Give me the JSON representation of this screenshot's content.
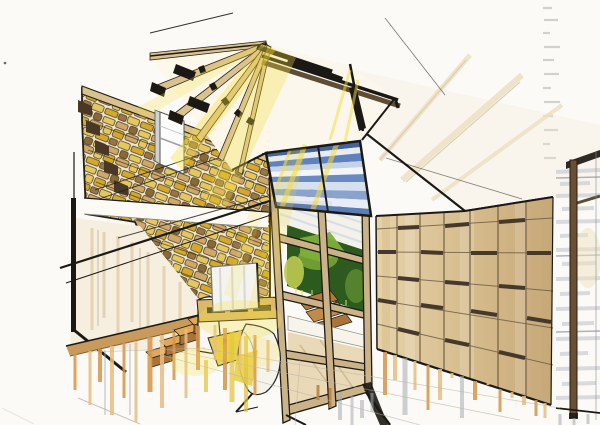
{
  "image": {
    "type": "architectural-marker-sketch",
    "description": "Hand-drawn marker and ink interior perspective: stone feature wall with staircase, exposed timber roof rafters with yellow sunlight rays, blue-striped clerestory glazing, timber glazed partition with green plant wall behind, wood panelled wall, media screen, chaise with drapery, floor dissolving into marker drips"
  },
  "scene": {
    "elements": [
      "stone-wall",
      "staircase",
      "roof-rafters",
      "ridge-beam",
      "clerestory-window",
      "sunlight-rays",
      "glass-partition",
      "plant-wall",
      "bench",
      "media-screen",
      "media-console",
      "chaise-longue",
      "wood-panel-wall",
      "glazed-door",
      "ceiling-plane",
      "marker-drips",
      "watermark"
    ]
  },
  "palette": {
    "paper": "#fbfaf6",
    "ink": "#1c1914",
    "stone_mortar": "#f0e6cc",
    "stone_ochre": "#d2a92a",
    "stone_gold": "#e4c75e",
    "stone_tan": "#cfa768",
    "stone_brown": "#9a7442",
    "stone_dark": "#8a6a34",
    "wood_beam": "#d9c190",
    "wood_line": "#5d4c36",
    "wood_floor": "#c89a5c",
    "step_tread": "#e2a858",
    "step_riser": "#a8743a",
    "sunlight": "#f6dd3e",
    "sky_dark": "#44639e",
    "sky_blue": "#5f82bd",
    "sky_light": "#aebfdd",
    "glass_gray": "#b6bcc4",
    "plant_dark": "#2d5a1f",
    "plant_mid": "#7fae3a",
    "plant_light": "#bcca51",
    "drip_orange": "#d89548",
    "drip_amber": "#e8bd85",
    "drip_gray": "#a8adb4",
    "cream": "#f6efdf",
    "screen_white": "#f4f3ef",
    "chaise_yellow": "#e8cf4e",
    "partition_frame": "#cbb389",
    "door_frame": "#6b4f33",
    "panel_light": "#e6d2aa",
    "panel_mid": "#d7bd8e",
    "panel_dark": "#c6a878"
  }
}
